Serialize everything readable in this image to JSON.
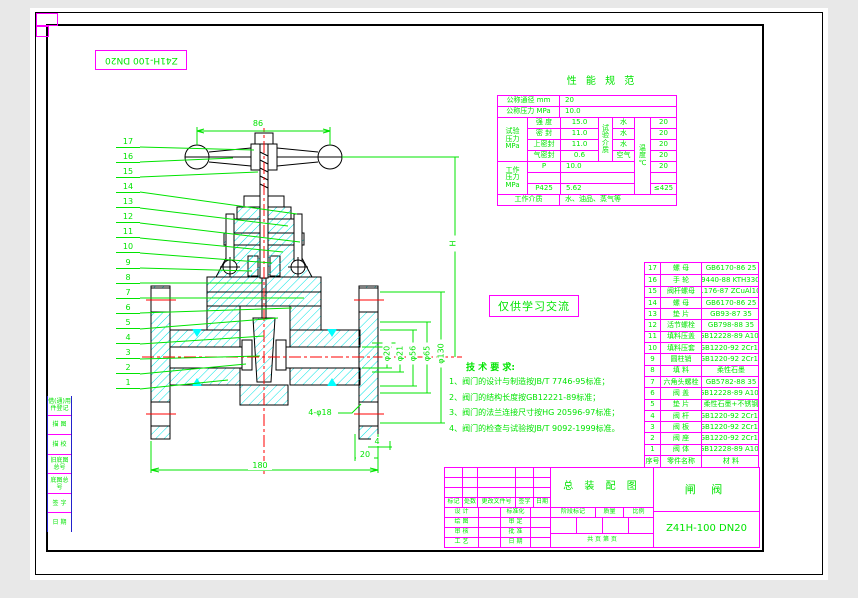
{
  "colors": {
    "line_green": "#00e400",
    "table_magenta": "#ff00ff",
    "hatch_cyan": "#00ffff",
    "centerline_red": "#ff0000"
  },
  "corner_label": "Z41H-100 DN20",
  "watermark": "仅供学习交流",
  "perf": {
    "title": "性 能 规 范",
    "r1_label": "公称通径 mm",
    "r1_value": "20",
    "r2_label": "公称压力 MPa",
    "r2_value": "10.0",
    "test_group_label": "试验\n压力\nMPa",
    "test_rows": [
      {
        "name": "强 度",
        "value": "15.0",
        "medium": "水",
        "temp": "20"
      },
      {
        "name": "密 封",
        "value": "11.0",
        "medium": "水",
        "temp": "20"
      },
      {
        "name": "上密封",
        "value": "11.0",
        "medium": "水",
        "temp": "20"
      },
      {
        "name": "气密封",
        "value": "0.6",
        "medium": "空气",
        "temp": "20"
      }
    ],
    "medium_group_label": "试\n验\n介\n质",
    "temp_group_label": "温\n度\n℃",
    "work_group_label": "工作\n压力\nMPa",
    "work_rows": [
      {
        "name": "P",
        "value": "10.0",
        "temp": "20"
      },
      {
        "name": "",
        "value": "",
        "temp": ""
      },
      {
        "name": "P425",
        "value": "5.62",
        "temp": "≤425"
      }
    ],
    "bottom_label": "工作介质",
    "bottom_value": "水、油品、蒸气等"
  },
  "tech": {
    "title": "技 术 要 求:",
    "items": [
      "1、阀门的设计与制造按JB/T 7746-95标准；",
      "2、阀门的结构长度按GB12221-89标准；",
      "3、阀门的法兰连接尺寸按HG 20596-97标准；",
      "4、阀门的检查与试验按JB/T 9092-1999标准。"
    ]
  },
  "bom": {
    "header": {
      "no": "序号",
      "name": "零件名称",
      "mat": "材  料"
    },
    "items": [
      {
        "no": "17",
        "name": "螺 母",
        "mat": "GB6170-86 25"
      },
      {
        "no": "16",
        "name": "手 轮",
        "mat": "GB9440-88 KTH330-08"
      },
      {
        "no": "15",
        "name": "阀杆螺母",
        "mat": "GB1176-87 ZCuAl10Fe3"
      },
      {
        "no": "14",
        "name": "螺 母",
        "mat": "GB6170-86 25"
      },
      {
        "no": "13",
        "name": "垫 片",
        "mat": "GB93-87 35"
      },
      {
        "no": "12",
        "name": "活节螺栓",
        "mat": "GB798-88 35"
      },
      {
        "no": "11",
        "name": "填料压盖",
        "mat": "GB12228-89 A105"
      },
      {
        "no": "10",
        "name": "填料压套",
        "mat": "GB1220-92 2Cr13"
      },
      {
        "no": "9",
        "name": "圆柱销",
        "mat": "GB1220-92 2Cr13"
      },
      {
        "no": "8",
        "name": "填 料",
        "mat": "柔性石墨"
      },
      {
        "no": "7",
        "name": "六角头螺栓",
        "mat": "GB5782-88 35"
      },
      {
        "no": "6",
        "name": "阀 盖",
        "mat": "GB12228-89 A105"
      },
      {
        "no": "5",
        "name": "垫 片",
        "mat": "柔性石墨+不锈钢"
      },
      {
        "no": "4",
        "name": "阀 杆",
        "mat": "GB1220-92 2Cr13"
      },
      {
        "no": "3",
        "name": "阀 板",
        "mat": "GB1220-92 2Cr13"
      },
      {
        "no": "2",
        "name": "阀 座",
        "mat": "GB1220-92 2Cr13"
      },
      {
        "no": "1",
        "name": "阀 体",
        "mat": "GB12228-89 A105"
      }
    ]
  },
  "balloons": [
    "17",
    "16",
    "15",
    "14",
    "13",
    "12",
    "11",
    "10",
    "9",
    "8",
    "7",
    "6",
    "5",
    "4",
    "3",
    "2",
    "1"
  ],
  "dims": {
    "top_width": "86",
    "height": "H",
    "d_bore": "φ20",
    "d_stem": "φ21",
    "d_seat": "φ56",
    "d_port": "φ65",
    "d_flange": "φ130",
    "bolt_holes": "4-φ18",
    "dim4": "4",
    "dim20": "20",
    "face_to_face": "180"
  },
  "titleblock": {
    "name": "总 装 配 图",
    "product": "闸  阀",
    "model": "Z41H-100 DN20",
    "rev_cols": [
      "标记",
      "处数",
      "更改文件号",
      "签字",
      "日期"
    ],
    "sign_left": [
      "设 计",
      "绘 图",
      "审 核",
      "工 艺"
    ],
    "sign_right": [
      "标准化",
      "审 定",
      "批 准",
      "日 期"
    ],
    "stage_cols": [
      "阶段标记",
      "质量",
      "比例"
    ],
    "pages": "共  页  第  页"
  },
  "margin_labels": [
    "借(通)用件登记",
    "描 图",
    "描 校",
    "旧底图总号",
    "底图总号",
    "签 字",
    "日 期"
  ]
}
